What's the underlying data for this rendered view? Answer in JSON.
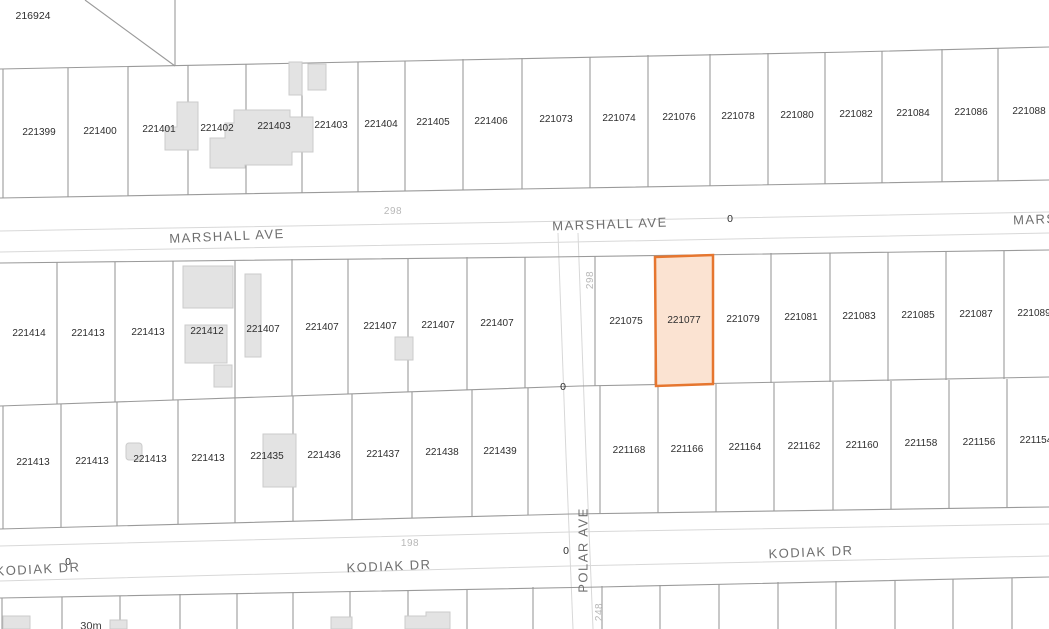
{
  "map": {
    "selected_parcel": "221077",
    "colors": {
      "highlight_fill": "#fbe3d2",
      "highlight_stroke": "#e6762f",
      "parcel_line": "#9a9a9a",
      "road_edge_line": "#d8d8d8",
      "building_fill": "#e3e3e3"
    },
    "labels": [
      {
        "text": "216924",
        "x": 33,
        "y": 16,
        "cls": "corner",
        "name": "corner-parcel-label"
      },
      {
        "text": "221399",
        "x": 39,
        "y": 133,
        "cls": "parcel",
        "name": "parcel-label"
      },
      {
        "text": "221400",
        "x": 100,
        "y": 132,
        "cls": "parcel",
        "name": "parcel-label"
      },
      {
        "text": "221401",
        "x": 159,
        "y": 130,
        "cls": "parcel",
        "name": "parcel-label"
      },
      {
        "text": "221402",
        "x": 217,
        "y": 129,
        "cls": "parcel",
        "name": "parcel-label"
      },
      {
        "text": "221403",
        "x": 274,
        "y": 127,
        "cls": "parcel",
        "name": "parcel-label"
      },
      {
        "text": "221403",
        "x": 331,
        "y": 126,
        "cls": "parcel",
        "name": "parcel-label"
      },
      {
        "text": "221404",
        "x": 381,
        "y": 125,
        "cls": "parcel",
        "name": "parcel-label"
      },
      {
        "text": "221405",
        "x": 433,
        "y": 123,
        "cls": "parcel",
        "name": "parcel-label"
      },
      {
        "text": "221406",
        "x": 491,
        "y": 122,
        "cls": "parcel",
        "name": "parcel-label"
      },
      {
        "text": "221073",
        "x": 556,
        "y": 120,
        "cls": "parcel",
        "name": "parcel-label"
      },
      {
        "text": "221074",
        "x": 619,
        "y": 119,
        "cls": "parcel",
        "name": "parcel-label"
      },
      {
        "text": "221076",
        "x": 679,
        "y": 118,
        "cls": "parcel",
        "name": "parcel-label"
      },
      {
        "text": "221078",
        "x": 738,
        "y": 117,
        "cls": "parcel",
        "name": "parcel-label"
      },
      {
        "text": "221080",
        "x": 797,
        "y": 116,
        "cls": "parcel",
        "name": "parcel-label"
      },
      {
        "text": "221082",
        "x": 856,
        "y": 115,
        "cls": "parcel",
        "name": "parcel-label"
      },
      {
        "text": "221084",
        "x": 913,
        "y": 114,
        "cls": "parcel",
        "name": "parcel-label"
      },
      {
        "text": "221086",
        "x": 971,
        "y": 113,
        "cls": "parcel",
        "name": "parcel-label"
      },
      {
        "text": "221088",
        "x": 1029,
        "y": 112,
        "cls": "parcel",
        "name": "parcel-label"
      },
      {
        "text": "221414",
        "x": 29,
        "y": 334,
        "cls": "parcel",
        "name": "parcel-label"
      },
      {
        "text": "221413",
        "x": 88,
        "y": 334,
        "cls": "parcel",
        "name": "parcel-label"
      },
      {
        "text": "221413",
        "x": 148,
        "y": 333,
        "cls": "parcel",
        "name": "parcel-label"
      },
      {
        "text": "221412",
        "x": 207,
        "y": 332,
        "cls": "parcel",
        "name": "parcel-label"
      },
      {
        "text": "221407",
        "x": 263,
        "y": 330,
        "cls": "parcel",
        "name": "parcel-label"
      },
      {
        "text": "221407",
        "x": 322,
        "y": 328,
        "cls": "parcel",
        "name": "parcel-label"
      },
      {
        "text": "221407",
        "x": 380,
        "y": 327,
        "cls": "parcel",
        "name": "parcel-label"
      },
      {
        "text": "221407",
        "x": 438,
        "y": 326,
        "cls": "parcel",
        "name": "parcel-label"
      },
      {
        "text": "221407",
        "x": 497,
        "y": 324,
        "cls": "parcel",
        "name": "parcel-label"
      },
      {
        "text": "221075",
        "x": 626,
        "y": 322,
        "cls": "parcel",
        "name": "parcel-label"
      },
      {
        "text": "221077",
        "x": 684,
        "y": 321,
        "cls": "parcel",
        "name": "selected-parcel-label"
      },
      {
        "text": "221079",
        "x": 743,
        "y": 320,
        "cls": "parcel",
        "name": "parcel-label"
      },
      {
        "text": "221081",
        "x": 801,
        "y": 318,
        "cls": "parcel",
        "name": "parcel-label"
      },
      {
        "text": "221083",
        "x": 859,
        "y": 317,
        "cls": "parcel",
        "name": "parcel-label"
      },
      {
        "text": "221085",
        "x": 918,
        "y": 316,
        "cls": "parcel",
        "name": "parcel-label"
      },
      {
        "text": "221087",
        "x": 976,
        "y": 315,
        "cls": "parcel",
        "name": "parcel-label"
      },
      {
        "text": "221089",
        "x": 1034,
        "y": 314,
        "cls": "parcel",
        "name": "parcel-label"
      },
      {
        "text": "221413",
        "x": 33,
        "y": 463,
        "cls": "parcel",
        "name": "parcel-label"
      },
      {
        "text": "221413",
        "x": 92,
        "y": 462,
        "cls": "parcel",
        "name": "parcel-label"
      },
      {
        "text": "221413",
        "x": 150,
        "y": 460,
        "cls": "parcel",
        "name": "parcel-label"
      },
      {
        "text": "221413",
        "x": 208,
        "y": 459,
        "cls": "parcel",
        "name": "parcel-label"
      },
      {
        "text": "221435",
        "x": 267,
        "y": 457,
        "cls": "parcel",
        "name": "parcel-label"
      },
      {
        "text": "221436",
        "x": 324,
        "y": 456,
        "cls": "parcel",
        "name": "parcel-label"
      },
      {
        "text": "221437",
        "x": 383,
        "y": 455,
        "cls": "parcel",
        "name": "parcel-label"
      },
      {
        "text": "221438",
        "x": 442,
        "y": 453,
        "cls": "parcel",
        "name": "parcel-label"
      },
      {
        "text": "221439",
        "x": 500,
        "y": 452,
        "cls": "parcel",
        "name": "parcel-label"
      },
      {
        "text": "221168",
        "x": 629,
        "y": 451,
        "cls": "parcel",
        "name": "parcel-label"
      },
      {
        "text": "221166",
        "x": 687,
        "y": 450,
        "cls": "parcel",
        "name": "parcel-label"
      },
      {
        "text": "221164",
        "x": 745,
        "y": 448,
        "cls": "parcel",
        "name": "parcel-label"
      },
      {
        "text": "221162",
        "x": 804,
        "y": 447,
        "cls": "parcel",
        "name": "parcel-label"
      },
      {
        "text": "221160",
        "x": 862,
        "y": 446,
        "cls": "parcel",
        "name": "parcel-label"
      },
      {
        "text": "221158",
        "x": 921,
        "y": 444,
        "cls": "parcel",
        "name": "parcel-label"
      },
      {
        "text": "221156",
        "x": 979,
        "y": 443,
        "cls": "parcel",
        "name": "parcel-label"
      },
      {
        "text": "221154",
        "x": 1036,
        "y": 441,
        "cls": "parcel",
        "name": "parcel-label"
      },
      {
        "text": "MARSHALL AVE",
        "x": 227,
        "y": 236,
        "cls": "street",
        "angle": -2.5,
        "name": "street-label-marshall-ave"
      },
      {
        "text": "MARSHALL AVE",
        "x": 610,
        "y": 224,
        "cls": "street",
        "angle": -2,
        "name": "street-label-marshall-ave"
      },
      {
        "text": "MARSHALL AVE",
        "x": 1013,
        "y": 218,
        "cls": "street",
        "angle": -2,
        "anchor": "left",
        "name": "street-label-marshall-ave"
      },
      {
        "text": "KODIAK DR",
        "x": 38,
        "y": 569,
        "cls": "street",
        "angle": -3,
        "name": "street-label-kodiak-dr"
      },
      {
        "text": "KODIAK DR",
        "x": 389,
        "y": 566,
        "cls": "street",
        "angle": -2.5,
        "name": "street-label-kodiak-dr"
      },
      {
        "text": "KODIAK DR",
        "x": 811,
        "y": 552,
        "cls": "street",
        "angle": -2.5,
        "name": "street-label-kodiak-dr"
      },
      {
        "text": "POLAR AVE",
        "x": 583,
        "y": 550,
        "cls": "street",
        "angle": -90,
        "name": "street-label-polar-ave"
      },
      {
        "text": "298",
        "x": 393,
        "y": 212,
        "cls": "measure",
        "name": "measurement-label"
      },
      {
        "text": "298",
        "x": 591,
        "y": 280,
        "cls": "measure",
        "angle": -90,
        "name": "measurement-label"
      },
      {
        "text": "198",
        "x": 410,
        "y": 544,
        "cls": "measure",
        "name": "measurement-label"
      },
      {
        "text": "248",
        "x": 600,
        "y": 612,
        "cls": "measure",
        "angle": -90,
        "name": "measurement-label"
      },
      {
        "text": "0",
        "x": 730,
        "y": 219,
        "cls": "measure-dark",
        "name": "measurement-label"
      },
      {
        "text": "0",
        "x": 563,
        "y": 387,
        "cls": "measure-dark",
        "name": "measurement-label"
      },
      {
        "text": "0",
        "x": 68,
        "y": 562,
        "cls": "measure-dark",
        "name": "measurement-label"
      },
      {
        "text": "0",
        "x": 566,
        "y": 551,
        "cls": "measure-dark",
        "name": "measurement-label"
      },
      {
        "text": "30m",
        "x": 91,
        "y": 627,
        "cls": "scale",
        "name": "scale-label"
      }
    ]
  }
}
